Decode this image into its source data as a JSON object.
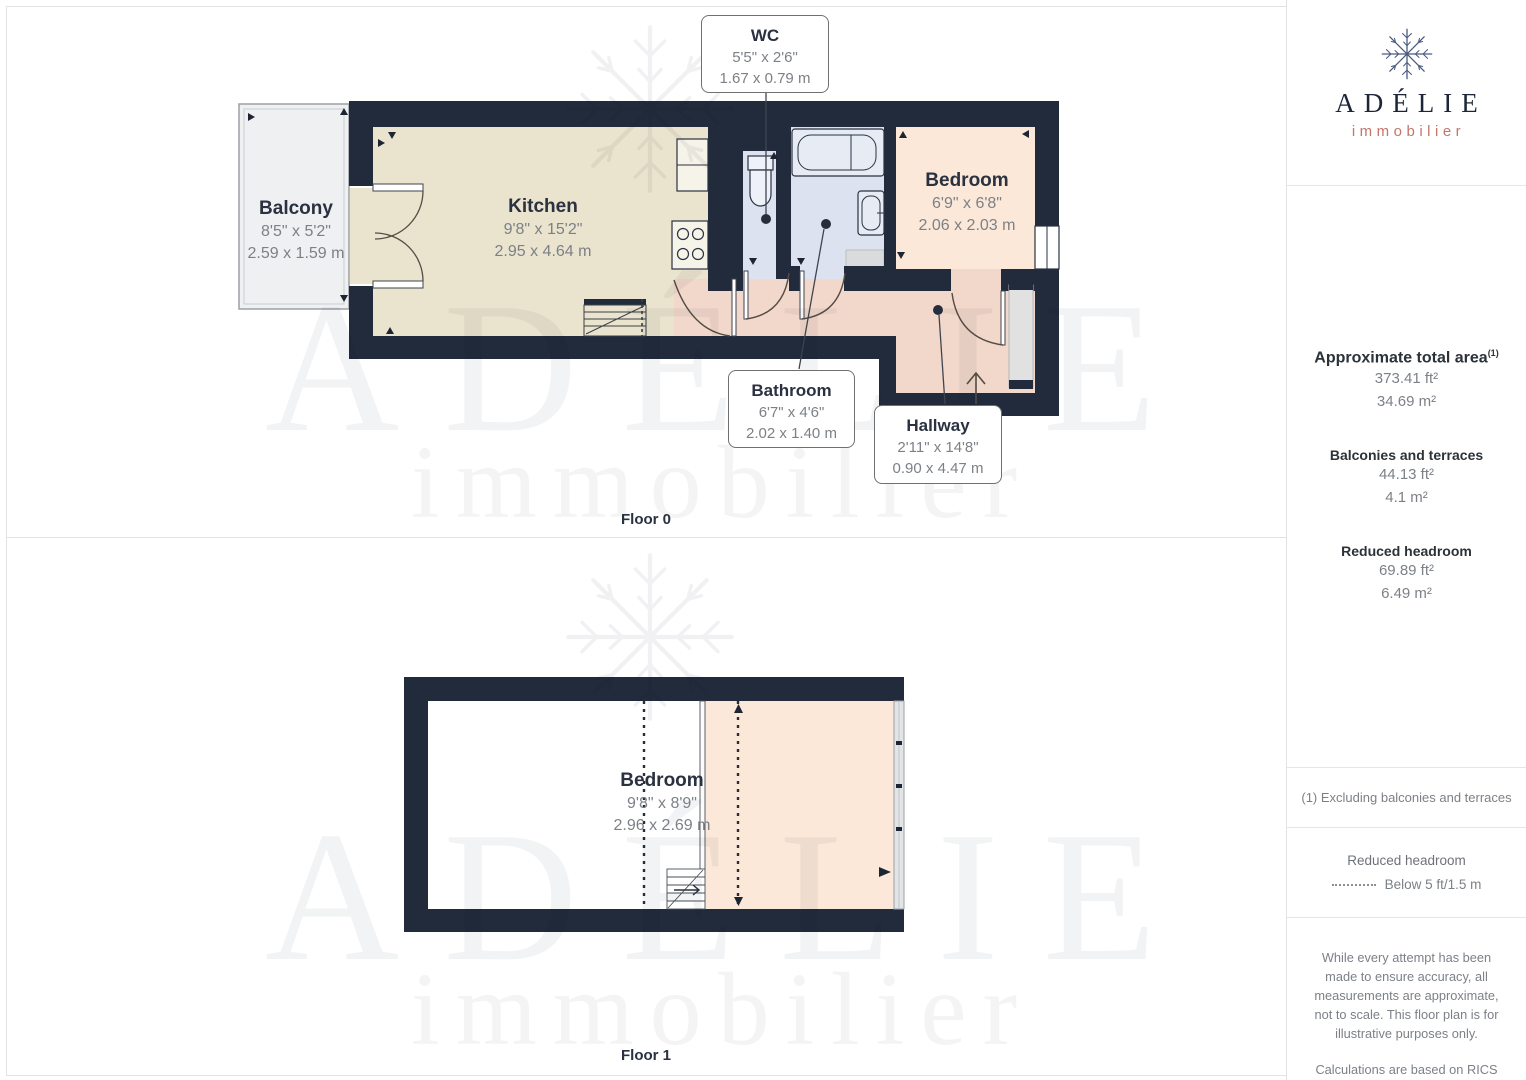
{
  "palette": {
    "wall": "#212b3c",
    "kitchen_floor": "#eae3cd",
    "bedroom_floor": "#fbe8d8",
    "hallway_floor": "#f2d8ca",
    "bathroom_floor": "#dce2f0",
    "balcony_floor": "#eff0f2",
    "brand_navy": "#1c2638",
    "brand_coral": "#c4766a",
    "label_dark": "#2a3140",
    "label_gray": "#7c8187"
  },
  "floor0": {
    "label": "Floor 0",
    "rooms": {
      "balcony": {
        "name": "Balcony",
        "imperial": "8'5\" x 5'2\"",
        "metric": "2.59 x 1.59 m"
      },
      "kitchen": {
        "name": "Kitchen",
        "imperial": "9'8\" x 15'2\"",
        "metric": "2.95 x 4.64 m"
      },
      "bedroom": {
        "name": "Bedroom",
        "imperial": "6'9\" x 6'8\"",
        "metric": "2.06 x 2.03 m"
      },
      "wc": {
        "name": "WC",
        "imperial": "5'5\" x 2'6\"",
        "metric": "1.67 x 0.79 m"
      },
      "bathroom": {
        "name": "Bathroom",
        "imperial": "6'7\" x 4'6\"",
        "metric": "2.02 x 1.40 m"
      },
      "hallway": {
        "name": "Hallway",
        "imperial": "2'11\" x 14'8\"",
        "metric": "0.90 x 4.47 m"
      }
    }
  },
  "floor1": {
    "label": "Floor 1",
    "rooms": {
      "bedroom": {
        "name": "Bedroom",
        "imperial": "9'8\" x 8'9\"",
        "metric": "2.96 x 2.69 m"
      }
    }
  },
  "watermark": {
    "name": "ADÉLIE",
    "tagline": "immobilier"
  },
  "sidebar": {
    "brand": {
      "name": "ADÉLIE",
      "tagline": "immobilier"
    },
    "areas": {
      "total": {
        "title": "Approximate total area",
        "sup": "(1)",
        "ft": "373.41 ft²",
        "m": "34.69 m²"
      },
      "balconies": {
        "title": "Balconies and terraces",
        "ft": "44.13 ft²",
        "m": "4.1 m²"
      },
      "reduced": {
        "title": "Reduced headroom",
        "ft": "69.89 ft²",
        "m": "6.49 m²"
      }
    },
    "footnote": "(1) Excluding balconies and terraces",
    "legend": {
      "title": "Reduced headroom",
      "item": "Below 5 ft/1.5 m"
    },
    "disclaimer1": "While every attempt has been made to ensure accuracy, all measurements are approximate, not to scale. This floor plan is for illustrative purposes only.",
    "disclaimer2": "Calculations are based on RICS IPMS 3C standard.",
    "brand_footer": {
      "name": "GIRAFFE",
      "suffix": "360"
    }
  }
}
